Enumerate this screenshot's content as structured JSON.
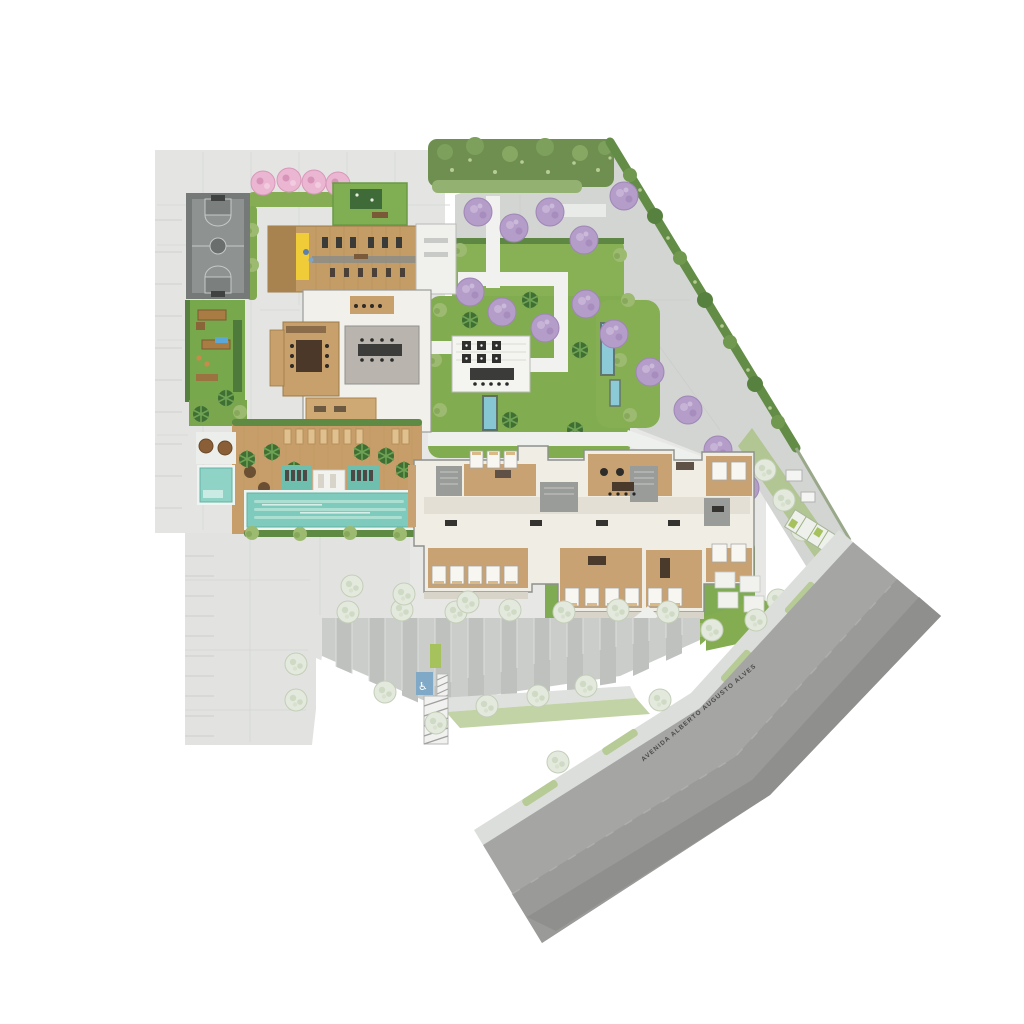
{
  "document": {
    "type": "architectural-site-plan",
    "view": "top-down implantation / ground-floor plan of a residential development"
  },
  "street": {
    "name": "AVENIDA ALBERTO AUGUSTO ALVES"
  },
  "icons": {
    "accessible": "♿"
  },
  "palette": {
    "background": "#ffffff",
    "podium_slab": "#e4e5e3",
    "plaza": "#d3d5d3",
    "parking": "#cbcdcb",
    "street": "#a5a6a4",
    "sidewalk": "#dcdedb",
    "lawn": "#84ad52",
    "hedge_dark": "#5f8a44",
    "shrub": "#9cba70",
    "wood_deck": "#c79e69",
    "pool_water": "#7ecabc",
    "building_floor": "#f0ede5",
    "building_wall": "#8d8f8d",
    "pink_tree": "#eab6d1",
    "purple_tree": "#b49dc8",
    "pale_tree": "#e4e9de",
    "yellow_accent": "#f0cc39",
    "accessible_blue": "#7fa9c6",
    "eco_stall_green": "#a5c25c",
    "water_feature": "#87c7d4"
  },
  "areas": [
    {
      "id": "basketball-court",
      "label": "Sports court"
    },
    {
      "id": "flowering-trees-walk",
      "label": "Pink flowering trees promenade"
    },
    {
      "id": "events-lawn",
      "label": "Lawn terrace with rug"
    },
    {
      "id": "fitness-center",
      "label": "Fitness deck with equipment"
    },
    {
      "id": "climbing-wall",
      "label": "Yellow climbing wall"
    },
    {
      "id": "social-lounges",
      "label": "Indoor social and gourmet rooms"
    },
    {
      "id": "outdoor-dining-terrace",
      "label": "Pergola dining terrace"
    },
    {
      "id": "reflecting-pool",
      "label": "Water feature"
    },
    {
      "id": "playground",
      "label": "Children playground"
    },
    {
      "id": "kids-pool",
      "label": "Kids pool"
    },
    {
      "id": "lap-pool",
      "label": "Lap pool with in-water loungers"
    },
    {
      "id": "pool-sun-deck",
      "label": "Timber sun deck"
    },
    {
      "id": "residential-building",
      "label": "Residential building ground-floor plan"
    },
    {
      "id": "private-patios",
      "label": "Private unit patios and courtyard gardens"
    },
    {
      "id": "landscaped-plaza",
      "label": "Paved plaza with purple flowering trees"
    },
    {
      "id": "perimeter-hedge",
      "label": "Perimeter hedge and tree buffer"
    },
    {
      "id": "surface-parking",
      "label": "Surface parking with shade trees"
    },
    {
      "id": "accessible-stall",
      "label": "Accessible parking stall"
    },
    {
      "id": "eco-stall",
      "label": "Green parking stall"
    },
    {
      "id": "pedestrian-crosswalk",
      "label": "Hatched pedestrian crossing"
    },
    {
      "id": "sidewalk",
      "label": "Sidewalk with planted verge"
    },
    {
      "id": "street",
      "label": "Avenue right-of-way"
    }
  ]
}
